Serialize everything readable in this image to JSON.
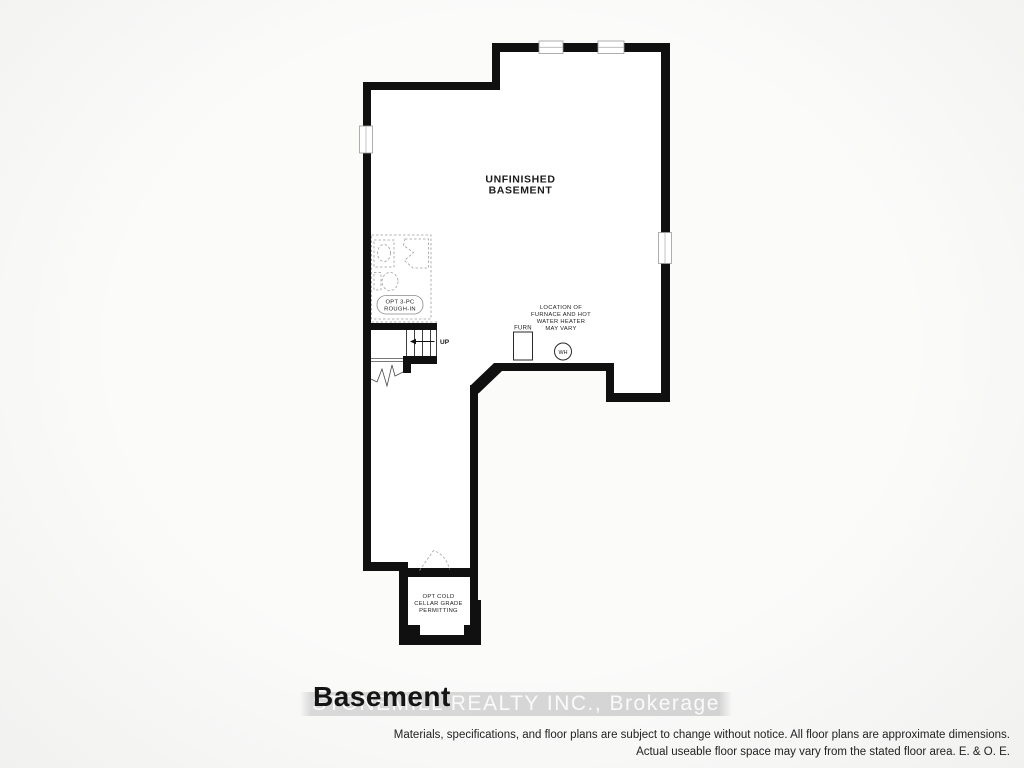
{
  "plan": {
    "wall_color": "#101010",
    "room_label_line1": "UNFINISHED",
    "room_label_line2": "BASEMENT",
    "bath_rough_in_line1": "OPT 3-PC",
    "bath_rough_in_line2": "ROUGH-IN",
    "stairs_direction": "UP",
    "furnace_label": "FURN",
    "water_heater_label": "WH",
    "hvac_note_line1": "LOCATION OF",
    "hvac_note_line2": "FURNACE AND HOT",
    "hvac_note_line3": "WATER HEATER",
    "hvac_note_line4": "MAY VARY",
    "cold_cellar_line1": "OPT COLD",
    "cold_cellar_line2": "CELLAR GRADE",
    "cold_cellar_line3": "PERMITTING"
  },
  "footer": {
    "floor_title": "Basement",
    "watermark": "STONEMILL REALTY INC.,  Brokerage",
    "disclaimer_line1": "Materials, specifications, and floor plans are subject to change without notice. All floor plans are approximate dimensions.",
    "disclaimer_line2": "Actual useable floor space may vary from the stated floor area. E. & O. E."
  }
}
